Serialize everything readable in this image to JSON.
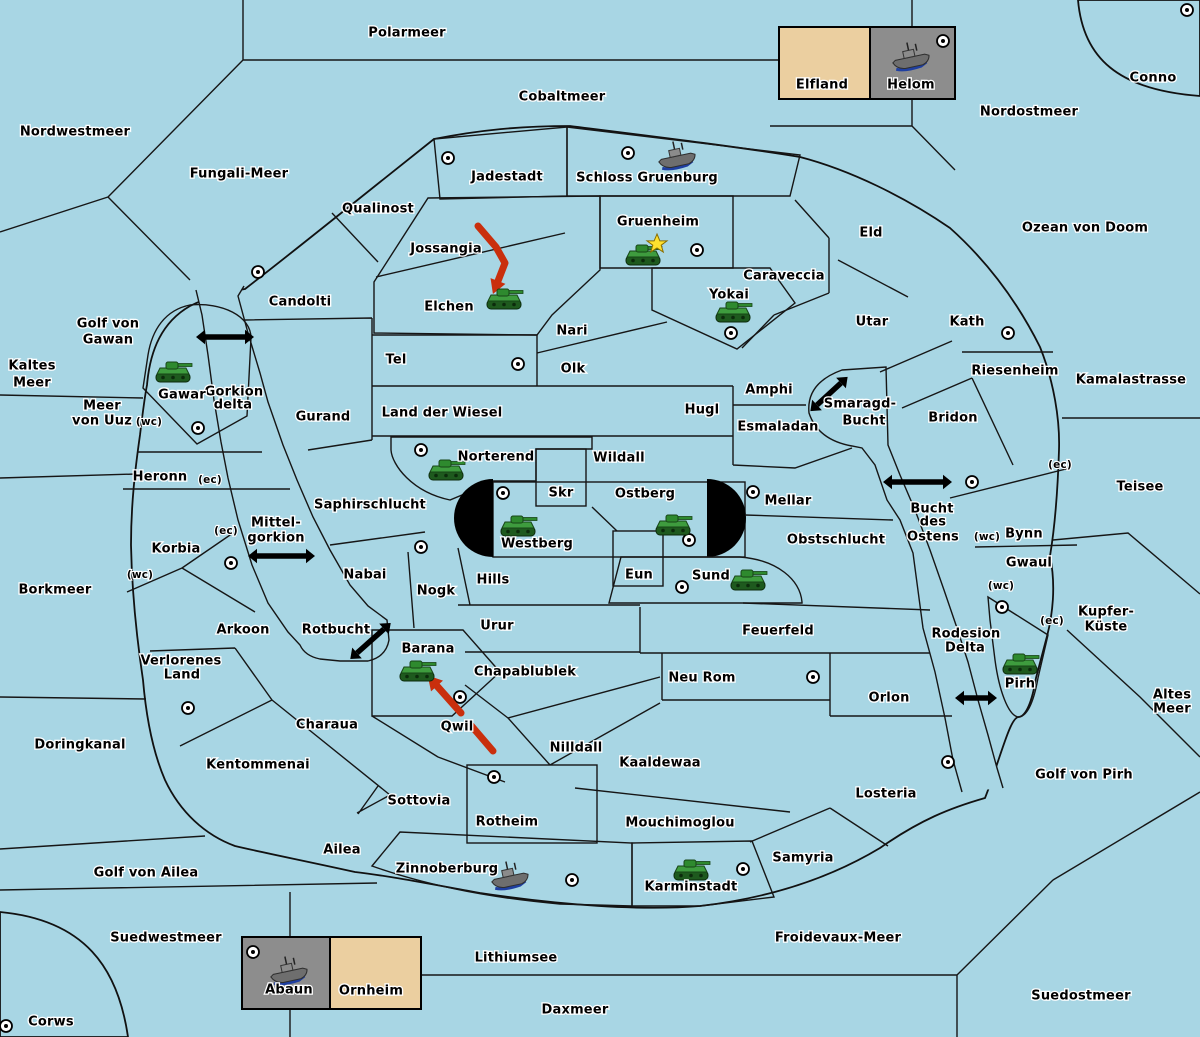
{
  "map_title": "Diplomacy variant game map",
  "colors": {
    "sea": "#A8D6E4",
    "land": "#EBCFA0",
    "green": "#A3C79C",
    "gray": "#8D8D8D",
    "gray_center": "#9D9D9D",
    "pink": "#BA8383",
    "black": "#000000",
    "border": "#161616",
    "attack_red": "#C92F0D",
    "star_yellow": "#FFE12E",
    "dot_fill": "#FFFFFF"
  },
  "labels": [
    {
      "t": "Polarmeer",
      "x": 407,
      "y": 33,
      "k": "sea"
    },
    {
      "t": "Cobaltmeer",
      "x": 562,
      "y": 97,
      "k": "sea"
    },
    {
      "t": "Nordostmeer",
      "x": 1029,
      "y": 112,
      "k": "sea"
    },
    {
      "t": "Nordwestmeer",
      "x": 75,
      "y": 132,
      "k": "sea"
    },
    {
      "t": "Fungali-Meer",
      "x": 239,
      "y": 174,
      "k": "sea"
    },
    {
      "t": "Ozean von Doom",
      "x": 1085,
      "y": 228,
      "k": "sea"
    },
    {
      "t": "Kaltes",
      "x": 32,
      "y": 366,
      "k": "sea"
    },
    {
      "t": "Meer",
      "x": 32,
      "y": 383,
      "k": "sea"
    },
    {
      "t": "Golf von",
      "x": 108,
      "y": 324,
      "k": "sea"
    },
    {
      "t": "Gawan",
      "x": 108,
      "y": 340,
      "k": "sea"
    },
    {
      "t": "Gorkion",
      "x": 234,
      "y": 392,
      "k": "sea"
    },
    {
      "t": "delta",
      "x": 233,
      "y": 405,
      "k": "sea"
    },
    {
      "t": "Meer",
      "x": 102,
      "y": 406,
      "k": "sea"
    },
    {
      "t": "von Uuz",
      "x": 102,
      "y": 421,
      "k": "sea"
    },
    {
      "t": "Borkmeer",
      "x": 55,
      "y": 590,
      "k": "sea"
    },
    {
      "t": "Mittel-",
      "x": 276,
      "y": 523,
      "k": "sea"
    },
    {
      "t": "gorkion",
      "x": 276,
      "y": 538,
      "k": "sea"
    },
    {
      "t": "Doringkanal",
      "x": 80,
      "y": 745,
      "k": "sea"
    },
    {
      "t": "Rotbucht",
      "x": 336,
      "y": 630,
      "k": "sea"
    },
    {
      "t": "Golf von Ailea",
      "x": 146,
      "y": 873,
      "k": "sea"
    },
    {
      "t": "Suedwestmeer",
      "x": 166,
      "y": 938,
      "k": "sea"
    },
    {
      "t": "Lithiumsee",
      "x": 516,
      "y": 958,
      "k": "sea"
    },
    {
      "t": "Daxmeer",
      "x": 575,
      "y": 1010,
      "k": "sea"
    },
    {
      "t": "Froidevaux-Meer",
      "x": 838,
      "y": 938,
      "k": "sea"
    },
    {
      "t": "Suedostmeer",
      "x": 1081,
      "y": 996,
      "k": "sea"
    },
    {
      "t": "Kamalastrasse",
      "x": 1131,
      "y": 380,
      "k": "sea"
    },
    {
      "t": "Teisee",
      "x": 1140,
      "y": 487,
      "k": "sea"
    },
    {
      "t": "Smaragd-",
      "x": 860,
      "y": 404,
      "k": "sea"
    },
    {
      "t": "Bucht",
      "x": 864,
      "y": 421,
      "k": "sea"
    },
    {
      "t": "Bucht",
      "x": 932,
      "y": 509,
      "k": "sea"
    },
    {
      "t": "des",
      "x": 933,
      "y": 522,
      "k": "sea"
    },
    {
      "t": "Ostens",
      "x": 933,
      "y": 537,
      "k": "sea"
    },
    {
      "t": "Rodesion",
      "x": 966,
      "y": 634,
      "k": "sea"
    },
    {
      "t": "Delta",
      "x": 965,
      "y": 648,
      "k": "sea"
    },
    {
      "t": "Kupfer-",
      "x": 1106,
      "y": 612,
      "k": "sea"
    },
    {
      "t": "Küste",
      "x": 1106,
      "y": 627,
      "k": "sea"
    },
    {
      "t": "Altes",
      "x": 1172,
      "y": 695,
      "k": "sea"
    },
    {
      "t": "Meer",
      "x": 1172,
      "y": 709,
      "k": "sea"
    },
    {
      "t": "Golf von Pirh",
      "x": 1084,
      "y": 775,
      "k": "sea"
    },
    {
      "t": "Conno",
      "x": 1153,
      "y": 78,
      "k": "land"
    },
    {
      "t": "Elfland",
      "x": 822,
      "y": 85,
      "k": "land"
    },
    {
      "t": "Helom",
      "x": 911,
      "y": 85,
      "k": "land"
    },
    {
      "t": "Qualinost",
      "x": 378,
      "y": 209,
      "k": "land"
    },
    {
      "t": "Jadestadt",
      "x": 507,
      "y": 177,
      "k": "land"
    },
    {
      "t": "Schloss Gruenburg",
      "x": 647,
      "y": 178,
      "k": "land"
    },
    {
      "t": "Jossangia",
      "x": 446,
      "y": 249,
      "k": "land"
    },
    {
      "t": "Elchen",
      "x": 449,
      "y": 307,
      "k": "land"
    },
    {
      "t": "Gruenheim",
      "x": 658,
      "y": 222,
      "k": "land"
    },
    {
      "t": "Yokai",
      "x": 729,
      "y": 295,
      "k": "land"
    },
    {
      "t": "Caraveccia",
      "x": 784,
      "y": 276,
      "k": "land"
    },
    {
      "t": "Eld",
      "x": 871,
      "y": 233,
      "k": "land"
    },
    {
      "t": "Utar",
      "x": 872,
      "y": 322,
      "k": "land"
    },
    {
      "t": "Kath",
      "x": 967,
      "y": 322,
      "k": "land"
    },
    {
      "t": "Riesenheim",
      "x": 1015,
      "y": 371,
      "k": "land"
    },
    {
      "t": "Bridon",
      "x": 953,
      "y": 418,
      "k": "land"
    },
    {
      "t": "Candolti",
      "x": 300,
      "y": 302,
      "k": "land"
    },
    {
      "t": "Tel",
      "x": 396,
      "y": 360,
      "k": "land"
    },
    {
      "t": "Gurand",
      "x": 323,
      "y": 417,
      "k": "land"
    },
    {
      "t": "Land der Wiesel",
      "x": 442,
      "y": 413,
      "k": "land"
    },
    {
      "t": "Nari",
      "x": 572,
      "y": 331,
      "k": "land"
    },
    {
      "t": "Olk",
      "x": 573,
      "y": 369,
      "k": "land"
    },
    {
      "t": "Hugl",
      "x": 702,
      "y": 410,
      "k": "land"
    },
    {
      "t": "Amphi",
      "x": 769,
      "y": 390,
      "k": "land"
    },
    {
      "t": "Esmaladan",
      "x": 778,
      "y": 427,
      "k": "land"
    },
    {
      "t": "Gawar",
      "x": 182,
      "y": 395,
      "k": "land"
    },
    {
      "t": "Heronn",
      "x": 160,
      "y": 477,
      "k": "land"
    },
    {
      "t": "Korbia",
      "x": 176,
      "y": 549,
      "k": "land"
    },
    {
      "t": "Saphirschlucht",
      "x": 370,
      "y": 505,
      "k": "land"
    },
    {
      "t": "Nabai",
      "x": 365,
      "y": 575,
      "k": "land"
    },
    {
      "t": "Nogk",
      "x": 436,
      "y": 591,
      "k": "land"
    },
    {
      "t": "Hills",
      "x": 493,
      "y": 580,
      "k": "land"
    },
    {
      "t": "Norterend",
      "x": 496,
      "y": 457,
      "k": "land"
    },
    {
      "t": "Skr",
      "x": 561,
      "y": 493,
      "k": "land"
    },
    {
      "t": "Westberg",
      "x": 537,
      "y": 544,
      "k": "land"
    },
    {
      "t": "Ostberg",
      "x": 645,
      "y": 494,
      "k": "land"
    },
    {
      "t": "Eun",
      "x": 639,
      "y": 575,
      "k": "land"
    },
    {
      "t": "Sund",
      "x": 711,
      "y": 576,
      "k": "land"
    },
    {
      "t": "Mellar",
      "x": 788,
      "y": 501,
      "k": "land"
    },
    {
      "t": "Wildall",
      "x": 619,
      "y": 458,
      "k": "land"
    },
    {
      "t": "Obstschlucht",
      "x": 836,
      "y": 540,
      "k": "land"
    },
    {
      "t": "Bynn",
      "x": 1024,
      "y": 534,
      "k": "land"
    },
    {
      "t": "Gwaul",
      "x": 1029,
      "y": 563,
      "k": "land"
    },
    {
      "t": "Pirh",
      "x": 1020,
      "y": 684,
      "k": "land"
    },
    {
      "t": "Arkoon",
      "x": 243,
      "y": 630,
      "k": "land"
    },
    {
      "t": "Verlorenes",
      "x": 181,
      "y": 661,
      "k": "land"
    },
    {
      "t": "Land",
      "x": 182,
      "y": 675,
      "k": "land"
    },
    {
      "t": "Charaua",
      "x": 327,
      "y": 725,
      "k": "land"
    },
    {
      "t": "Kentommenai",
      "x": 258,
      "y": 765,
      "k": "land"
    },
    {
      "t": "Barana",
      "x": 428,
      "y": 649,
      "k": "land"
    },
    {
      "t": "Qwil",
      "x": 457,
      "y": 727,
      "k": "land"
    },
    {
      "t": "Urur",
      "x": 497,
      "y": 626,
      "k": "land"
    },
    {
      "t": "Chapablublek",
      "x": 525,
      "y": 672,
      "k": "land"
    },
    {
      "t": "Feuerfeld",
      "x": 778,
      "y": 631,
      "k": "land"
    },
    {
      "t": "Neu Rom",
      "x": 702,
      "y": 678,
      "k": "land"
    },
    {
      "t": "Nilldall",
      "x": 576,
      "y": 748,
      "k": "land"
    },
    {
      "t": "Kaaldewaa",
      "x": 660,
      "y": 763,
      "k": "land"
    },
    {
      "t": "Orlon",
      "x": 889,
      "y": 698,
      "k": "land"
    },
    {
      "t": "Sottovia",
      "x": 419,
      "y": 801,
      "k": "land"
    },
    {
      "t": "Ailea",
      "x": 342,
      "y": 850,
      "k": "land"
    },
    {
      "t": "Rotheim",
      "x": 507,
      "y": 822,
      "k": "land"
    },
    {
      "t": "Zinnoberburg",
      "x": 447,
      "y": 869,
      "k": "land"
    },
    {
      "t": "Karminstadt",
      "x": 691,
      "y": 887,
      "k": "land"
    },
    {
      "t": "Mouchimoglou",
      "x": 680,
      "y": 823,
      "k": "land"
    },
    {
      "t": "Samyria",
      "x": 803,
      "y": 858,
      "k": "land"
    },
    {
      "t": "Losteria",
      "x": 886,
      "y": 794,
      "k": "land"
    },
    {
      "t": "Abaun",
      "x": 289,
      "y": 990,
      "k": "land"
    },
    {
      "t": "Ornheim",
      "x": 371,
      "y": 991,
      "k": "land"
    },
    {
      "t": "Corws",
      "x": 51,
      "y": 1022,
      "k": "land"
    },
    {
      "t": "(wc)",
      "x": 149,
      "y": 422,
      "k": "small"
    },
    {
      "t": "(ec)",
      "x": 210,
      "y": 480,
      "k": "small"
    },
    {
      "t": "(ec)",
      "x": 226,
      "y": 531,
      "k": "small"
    },
    {
      "t": "(wc)",
      "x": 140,
      "y": 575,
      "k": "small"
    },
    {
      "t": "(ec)",
      "x": 1060,
      "y": 465,
      "k": "small"
    },
    {
      "t": "(wc)",
      "x": 987,
      "y": 537,
      "k": "small"
    },
    {
      "t": "(wc)",
      "x": 1001,
      "y": 586,
      "k": "small"
    },
    {
      "t": "(ec)",
      "x": 1052,
      "y": 621,
      "k": "small"
    }
  ],
  "supply_centers": [
    {
      "r": "conno",
      "x": 1187,
      "y": 10
    },
    {
      "r": "helom",
      "x": 943,
      "y": 41
    },
    {
      "r": "jadestadt",
      "x": 448,
      "y": 158
    },
    {
      "r": "schloss-gruenburg",
      "x": 628,
      "y": 153
    },
    {
      "r": "gruenheim",
      "x": 697,
      "y": 250
    },
    {
      "r": "yokai",
      "x": 731,
      "y": 333
    },
    {
      "r": "candolti",
      "x": 258,
      "y": 272
    },
    {
      "r": "tel",
      "x": 518,
      "y": 364
    },
    {
      "r": "gawar",
      "x": 198,
      "y": 428
    },
    {
      "r": "norterend",
      "x": 421,
      "y": 450
    },
    {
      "r": "westberg",
      "x": 503,
      "y": 493
    },
    {
      "r": "ostberg",
      "x": 689,
      "y": 540
    },
    {
      "r": "sund",
      "x": 682,
      "y": 587
    },
    {
      "r": "mellar",
      "x": 753,
      "y": 492
    },
    {
      "r": "bridon",
      "x": 972,
      "y": 482
    },
    {
      "r": "kath",
      "x": 1008,
      "y": 333
    },
    {
      "r": "pirh",
      "x": 1002,
      "y": 607
    },
    {
      "r": "nogk",
      "x": 421,
      "y": 547
    },
    {
      "r": "korbia",
      "x": 231,
      "y": 563
    },
    {
      "r": "verlorenes-land",
      "x": 188,
      "y": 708
    },
    {
      "r": "qwil",
      "x": 460,
      "y": 697
    },
    {
      "r": "neu-rom",
      "x": 813,
      "y": 677
    },
    {
      "r": "rotheim",
      "x": 494,
      "y": 777
    },
    {
      "r": "zinnoberburg",
      "x": 572,
      "y": 880
    },
    {
      "r": "karminstadt",
      "x": 743,
      "y": 869
    },
    {
      "r": "losteria",
      "x": 948,
      "y": 762
    },
    {
      "r": "abaun",
      "x": 253,
      "y": 952
    },
    {
      "r": "corws",
      "x": 6,
      "y": 1026
    }
  ],
  "units": [
    {
      "t": "tank",
      "r": "gawar",
      "x": 173,
      "y": 372
    },
    {
      "t": "tank",
      "r": "elchen",
      "x": 504,
      "y": 299
    },
    {
      "t": "tank",
      "r": "gruenheim",
      "x": 643,
      "y": 255,
      "star": true
    },
    {
      "t": "tank",
      "r": "yokai",
      "x": 733,
      "y": 312
    },
    {
      "t": "tank",
      "r": "norterend",
      "x": 446,
      "y": 470
    },
    {
      "t": "tank",
      "r": "westberg",
      "x": 518,
      "y": 526
    },
    {
      "t": "tank",
      "r": "ostberg",
      "x": 673,
      "y": 525
    },
    {
      "t": "tank",
      "r": "sund",
      "x": 748,
      "y": 580
    },
    {
      "t": "tank",
      "r": "barana",
      "x": 417,
      "y": 671
    },
    {
      "t": "tank",
      "r": "karminstadt",
      "x": 691,
      "y": 870
    },
    {
      "t": "tank",
      "r": "pirh",
      "x": 1020,
      "y": 664
    },
    {
      "t": "ship",
      "r": "helom",
      "x": 911,
      "y": 57
    },
    {
      "t": "ship",
      "r": "schloss-gruenburg",
      "x": 677,
      "y": 156
    },
    {
      "t": "ship",
      "r": "zinnoberburg",
      "x": 510,
      "y": 876
    },
    {
      "t": "ship",
      "r": "abaun",
      "x": 289,
      "y": 971
    }
  ],
  "star_marker": {
    "x": 657,
    "y": 244
  },
  "link_arrows": [
    {
      "n": "gorkion-delta",
      "x1": 205,
      "y1": 337,
      "x2": 245,
      "y2": 337
    },
    {
      "n": "mittel-gorkion",
      "x1": 257,
      "y1": 556,
      "x2": 306,
      "y2": 556
    },
    {
      "n": "rotbucht",
      "x1": 357,
      "y1": 653,
      "x2": 384,
      "y2": 629
    },
    {
      "n": "smaragd-bucht",
      "x1": 817,
      "y1": 405,
      "x2": 841,
      "y2": 383
    },
    {
      "n": "bucht-des-ostens",
      "x1": 892,
      "y1": 482,
      "x2": 943,
      "y2": 482
    },
    {
      "n": "rodesion-delta",
      "x1": 964,
      "y1": 698,
      "x2": 988,
      "y2": 698
    }
  ],
  "attack_arrows": [
    {
      "n": "attack-elchen",
      "segs": [
        [
          [
            478,
            226
          ],
          [
            496,
            247
          ],
          [
            505,
            263
          ],
          [
            498,
            281
          ]
        ]
      ]
    },
    {
      "n": "attack-barana",
      "segs": [
        [
          [
            493,
            751
          ],
          [
            469,
            723
          ]
        ],
        [
          [
            461,
            713
          ],
          [
            437,
            686
          ]
        ]
      ]
    }
  ]
}
